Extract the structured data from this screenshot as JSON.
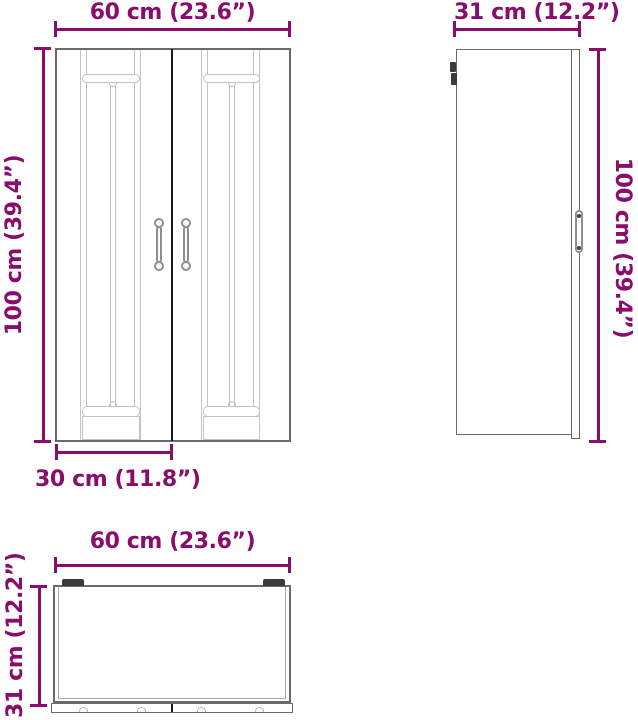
{
  "colors": {
    "dimension": "#8a0c6c",
    "cabinet_outline": "#6a6a6a",
    "panel_detail": "#c3c3c3",
    "door_split": "#1c1c1c",
    "hardware": "#3b3b3b"
  },
  "views": {
    "front": {
      "width": {
        "cm": 60,
        "inch": 23.6,
        "label": "60 cm (23.6”)"
      },
      "height": {
        "cm": 100,
        "inch": 39.4,
        "label": "100 cm (39.4”)"
      },
      "door_width": {
        "cm": 30,
        "inch": 11.8,
        "label": "30 cm (11.8”)"
      }
    },
    "side": {
      "depth": {
        "cm": 31,
        "inch": 12.2,
        "label": "31 cm (12.2”)"
      },
      "height": {
        "cm": 100,
        "inch": 39.4,
        "label": "100 cm (39.4”)"
      }
    },
    "top": {
      "width": {
        "cm": 60,
        "inch": 23.6,
        "label": "60 cm (23.6”)"
      },
      "depth": {
        "cm": 31,
        "inch": 12.2,
        "label": "31 cm (12.2”)"
      }
    }
  }
}
